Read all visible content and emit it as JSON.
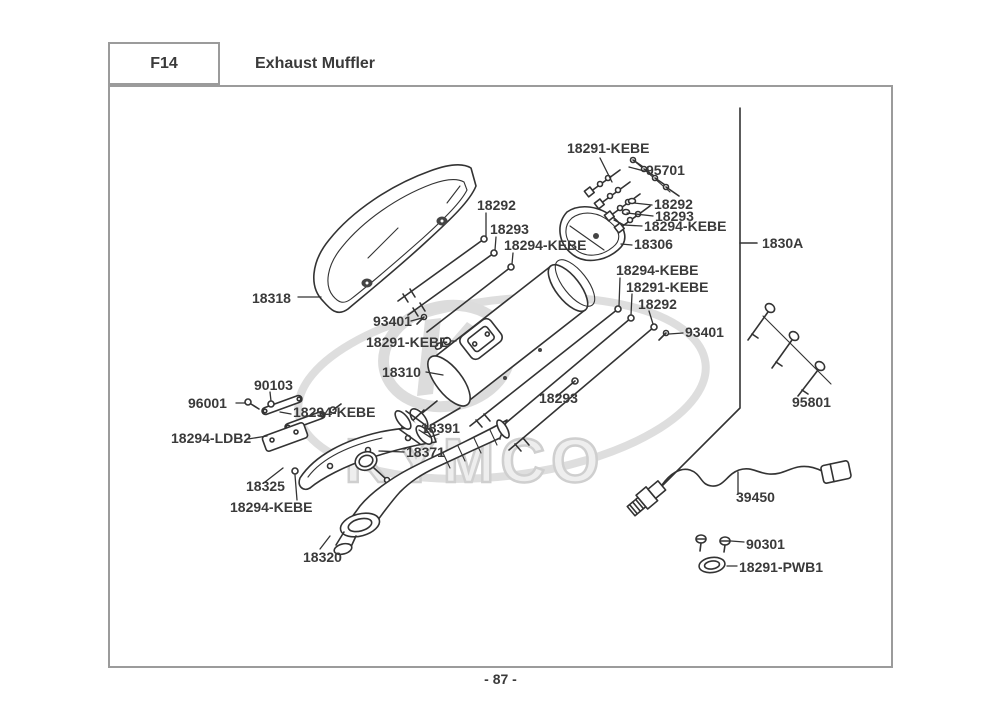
{
  "header": {
    "code": "F14",
    "title": "Exhaust Muffler"
  },
  "footer": {
    "page": "- 87 -"
  },
  "watermark": {
    "brand": "KYMCO"
  },
  "colors": {
    "line": "#333333",
    "label_text": "#3a3a3a",
    "frame_border": "#9b9b9b",
    "watermark": "#d9d9d9"
  },
  "labels": [
    {
      "text": "18291-KEBE"
    },
    {
      "text": "95701"
    },
    {
      "text": "18292"
    },
    {
      "text": "18293"
    },
    {
      "text": "18294-KEBE"
    },
    {
      "text": "18306"
    },
    {
      "text": "1830A"
    },
    {
      "text": "18292"
    },
    {
      "text": "18293"
    },
    {
      "text": "18294-KEBE"
    },
    {
      "text": "18318"
    },
    {
      "text": "93401"
    },
    {
      "text": "18291-KEBE"
    },
    {
      "text": "18310"
    },
    {
      "text": "18294-KEBE"
    },
    {
      "text": "18291-KEBE"
    },
    {
      "text": "18292"
    },
    {
      "text": "93401"
    },
    {
      "text": "18293"
    },
    {
      "text": "95801"
    },
    {
      "text": "90103"
    },
    {
      "text": "96001"
    },
    {
      "text": "18294-KEBE"
    },
    {
      "text": "18294-LDB2"
    },
    {
      "text": "18391"
    },
    {
      "text": "18371"
    },
    {
      "text": "18325"
    },
    {
      "text": "18294-KEBE"
    },
    {
      "text": "18320"
    },
    {
      "text": "39450"
    },
    {
      "text": "90301"
    },
    {
      "text": "18291-PWB1"
    }
  ]
}
